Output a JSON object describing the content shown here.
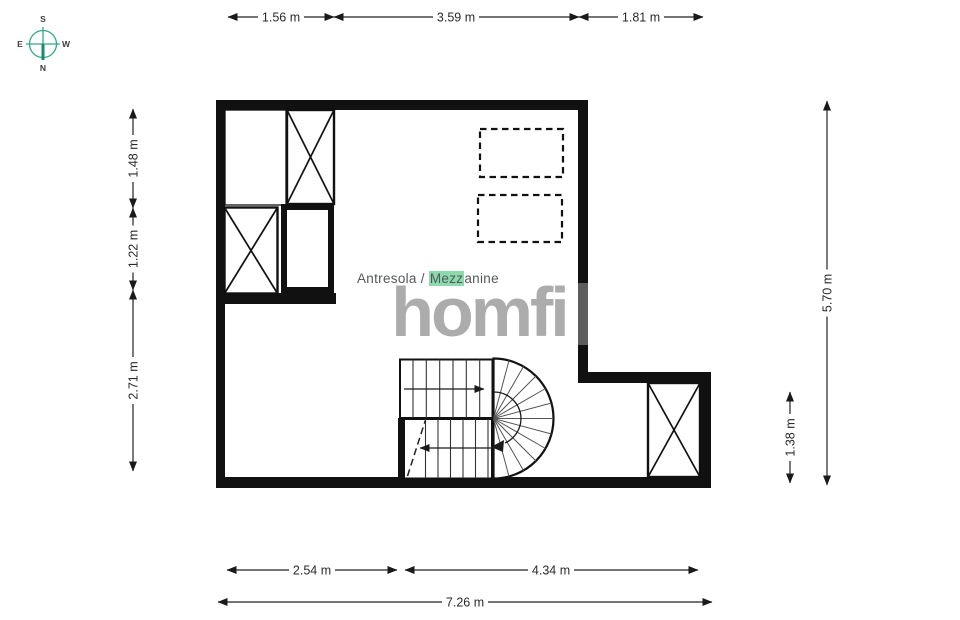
{
  "watermark": {
    "text": "homfi"
  },
  "room_label": {
    "pre": "Antresola / ",
    "highlight": "Mezz",
    "post": "anine"
  },
  "compass": {
    "top": "S",
    "bottom": "N",
    "left": "E",
    "right": "W"
  },
  "dimensions": {
    "top": [
      "1.56 m",
      "3.59 m",
      "1.81 m"
    ],
    "left": [
      "1.48 m",
      "1.22 m",
      "2.71 m"
    ],
    "right": [
      "5.70 m",
      "1.38 m"
    ],
    "bottom": [
      "2.54 m",
      "4.34 m"
    ],
    "total": "7.26 m"
  },
  "colors": {
    "wall": "#111111",
    "dimension": "#2a2a2a",
    "watermark_gray": "#9a9a9a",
    "highlight_green": "#8bd9ac",
    "compass_teal": "#33a98c",
    "label_gray": "#54585a"
  }
}
